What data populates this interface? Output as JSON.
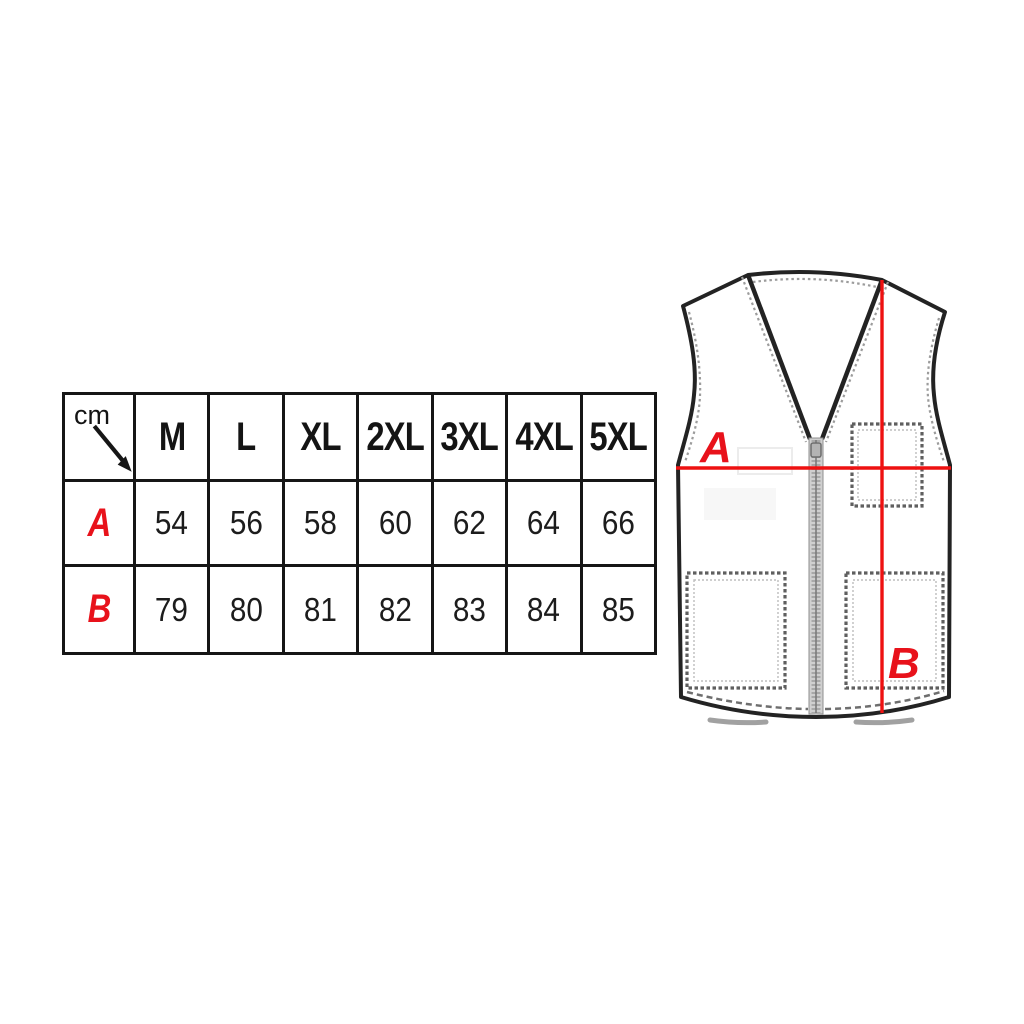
{
  "colors": {
    "background": "#ffffff",
    "table_border": "#161616",
    "text_black": "#1c1c1c",
    "label_red": "#e8121b",
    "measure_red": "#ee1111",
    "vest_outline": "#232323",
    "stitch_gray": "#9c9c9c",
    "pocket_stitch": "#5f5f5f",
    "zipper_gray": "#cfcfcf"
  },
  "size_table": {
    "unit_label": "cm",
    "columns": [
      "M",
      "L",
      "XL",
      "2XL",
      "3XL",
      "4XL",
      "5XL"
    ],
    "rows": [
      {
        "label": "A",
        "values": [
          "54",
          "56",
          "58",
          "60",
          "62",
          "64",
          "66"
        ]
      },
      {
        "label": "B",
        "values": [
          "79",
          "80",
          "81",
          "82",
          "83",
          "84",
          "85"
        ]
      }
    ]
  },
  "vest_diagram": {
    "width_label": "A",
    "length_label": "B"
  }
}
